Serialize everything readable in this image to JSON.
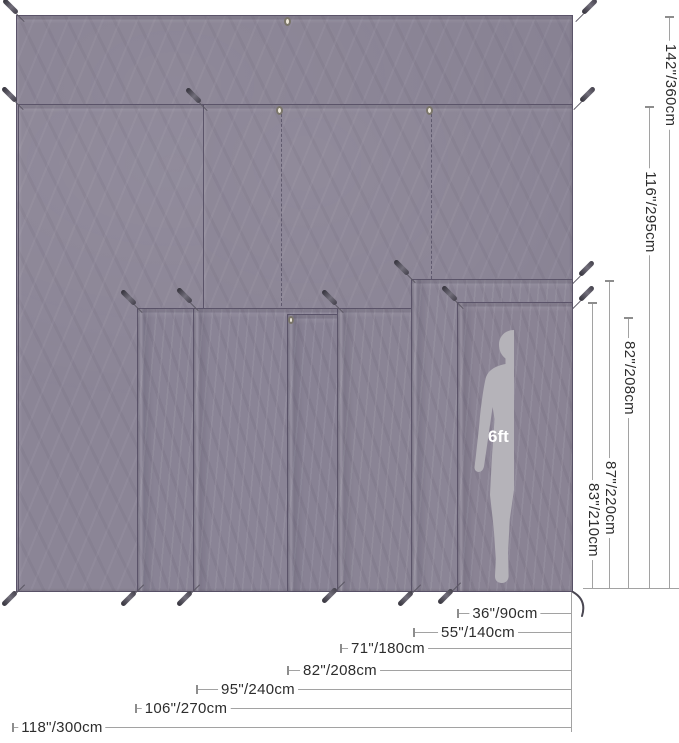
{
  "diagram": {
    "description": "Tarp footprint size comparison diagram with stacked ground sheets, corner stakes, grommets and a human figure for scale",
    "scale_figure": {
      "label": "6ft"
    },
    "colors": {
      "background": "#ffffff",
      "tarp": "#8a8495",
      "tarp_edge": "#5d5768",
      "dimension_line": "#a2a2a2",
      "dimension_text": "#2d2d2d",
      "stake": "#45424d",
      "grommet": "#efe9dc",
      "silhouette_fill": "#b5b3b9",
      "silhouette_outline": "#dad8de"
    },
    "height_dims": [
      {
        "label": "142\"/360cm"
      },
      {
        "label": "116\"/295cm"
      },
      {
        "label": "82\"/208cm"
      },
      {
        "label": "87\"/220cm"
      },
      {
        "label": "83\"/210cm"
      }
    ],
    "width_dims": [
      {
        "label": "36\"/90cm"
      },
      {
        "label": "55\"/140cm"
      },
      {
        "label": "71\"/180cm"
      },
      {
        "label": "82\"/208cm"
      },
      {
        "label": "95\"/240cm"
      },
      {
        "label": "106\"/270cm"
      },
      {
        "label": "118\"/300cm"
      }
    ]
  }
}
